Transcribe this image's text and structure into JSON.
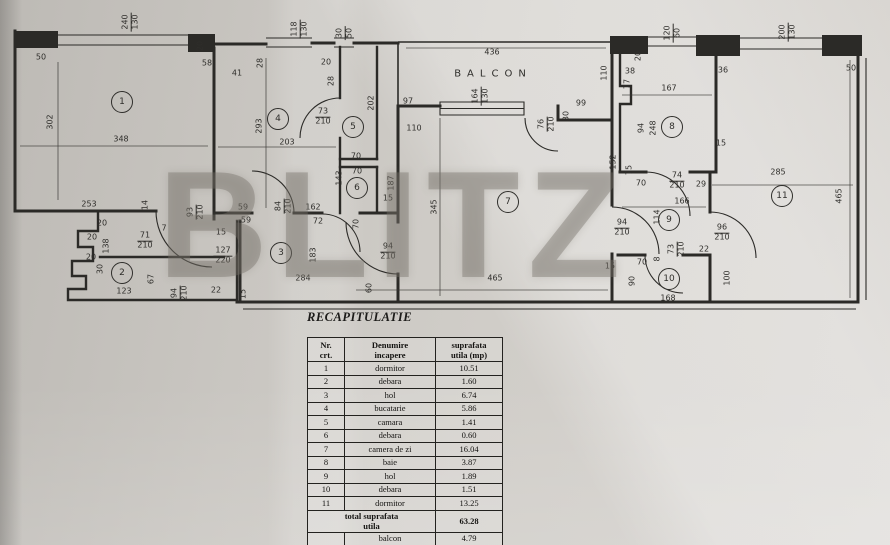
{
  "watermark": "BLITZ",
  "plan": {
    "balcony_label": "BALCON",
    "room_markers": [
      {
        "n": "1",
        "x": 122,
        "y": 102
      },
      {
        "n": "2",
        "x": 122,
        "y": 273
      },
      {
        "n": "3",
        "x": 281,
        "y": 253
      },
      {
        "n": "4",
        "x": 278,
        "y": 119
      },
      {
        "n": "5",
        "x": 353,
        "y": 127
      },
      {
        "n": "6",
        "x": 357,
        "y": 188
      },
      {
        "n": "7",
        "x": 508,
        "y": 202
      },
      {
        "n": "8",
        "x": 672,
        "y": 127
      },
      {
        "n": "9",
        "x": 669,
        "y": 220
      },
      {
        "n": "10",
        "x": 669,
        "y": 279
      },
      {
        "n": "11",
        "x": 782,
        "y": 196
      }
    ],
    "dim_labels": [
      {
        "t": "50",
        "x": 41,
        "y": 57
      },
      {
        "t": "20",
        "x": 200,
        "y": 46,
        "r": -90
      },
      {
        "t": "58",
        "x": 207,
        "y": 63
      },
      {
        "t": "302",
        "x": 50,
        "y": 122,
        "r": -90
      },
      {
        "t": "348",
        "x": 121,
        "y": 139
      },
      {
        "t": "253",
        "x": 89,
        "y": 204
      },
      {
        "t": "14",
        "x": 145,
        "y": 205,
        "r": -90
      },
      {
        "t": "7",
        "x": 164,
        "y": 228
      },
      {
        "t": "20",
        "x": 102,
        "y": 223
      },
      {
        "t": "20",
        "x": 92,
        "y": 237
      },
      {
        "t": "20",
        "x": 91,
        "y": 257
      },
      {
        "t": "138",
        "x": 106,
        "y": 246,
        "r": -90
      },
      {
        "t": "30",
        "x": 100,
        "y": 269,
        "r": -90
      },
      {
        "t": "123",
        "x": 124,
        "y": 291
      },
      {
        "t": "67",
        "x": 151,
        "y": 279,
        "r": -90
      },
      {
        "t": "59",
        "x": 243,
        "y": 207
      },
      {
        "t": "59",
        "x": 246,
        "y": 220
      },
      {
        "t": "15",
        "x": 221,
        "y": 232
      },
      {
        "t": "22",
        "x": 216,
        "y": 290
      },
      {
        "t": "15",
        "x": 243,
        "y": 294,
        "r": -90
      },
      {
        "t": "28",
        "x": 260,
        "y": 63,
        "r": -90
      },
      {
        "t": "41",
        "x": 237,
        "y": 73
      },
      {
        "t": "20",
        "x": 326,
        "y": 62
      },
      {
        "t": "28",
        "x": 331,
        "y": 81,
        "r": -90
      },
      {
        "t": "293",
        "x": 259,
        "y": 126,
        "r": -90
      },
      {
        "t": "203",
        "x": 287,
        "y": 142
      },
      {
        "t": "202",
        "x": 371,
        "y": 103,
        "r": -90
      },
      {
        "t": "97",
        "x": 408,
        "y": 101
      },
      {
        "t": "110",
        "x": 414,
        "y": 128
      },
      {
        "t": "70",
        "x": 356,
        "y": 156
      },
      {
        "t": "70",
        "x": 357,
        "y": 171
      },
      {
        "t": "143",
        "x": 339,
        "y": 178,
        "r": -90
      },
      {
        "t": "187",
        "x": 391,
        "y": 183,
        "r": -90
      },
      {
        "t": "15",
        "x": 388,
        "y": 198
      },
      {
        "t": "162",
        "x": 313,
        "y": 207
      },
      {
        "t": "72",
        "x": 318,
        "y": 221
      },
      {
        "t": "70",
        "x": 356,
        "y": 224,
        "r": -90
      },
      {
        "t": "183",
        "x": 313,
        "y": 255,
        "r": -90
      },
      {
        "t": "284",
        "x": 303,
        "y": 278
      },
      {
        "t": "60",
        "x": 369,
        "y": 288,
        "r": -90
      },
      {
        "t": "436",
        "x": 492,
        "y": 52
      },
      {
        "t": "345",
        "x": 434,
        "y": 207,
        "r": -90
      },
      {
        "t": "465",
        "x": 495,
        "y": 278
      },
      {
        "t": "99",
        "x": 581,
        "y": 103
      },
      {
        "t": "30",
        "x": 566,
        "y": 116,
        "r": -90
      },
      {
        "t": "20",
        "x": 638,
        "y": 56,
        "r": -90
      },
      {
        "t": "38",
        "x": 630,
        "y": 71
      },
      {
        "t": "77",
        "x": 627,
        "y": 84,
        "r": -90
      },
      {
        "t": "167",
        "x": 669,
        "y": 88
      },
      {
        "t": "36",
        "x": 723,
        "y": 70
      },
      {
        "t": "110",
        "x": 604,
        "y": 73,
        "r": -90
      },
      {
        "t": "50",
        "x": 851,
        "y": 68
      },
      {
        "t": "94",
        "x": 641,
        "y": 128,
        "r": -90
      },
      {
        "t": "248",
        "x": 653,
        "y": 128,
        "r": -90
      },
      {
        "t": "15",
        "x": 721,
        "y": 143
      },
      {
        "t": "285",
        "x": 778,
        "y": 172
      },
      {
        "t": "465",
        "x": 839,
        "y": 196,
        "r": -90
      },
      {
        "t": "152",
        "x": 613,
        "y": 162,
        "r": -90
      },
      {
        "t": "75",
        "x": 629,
        "y": 170,
        "r": -90
      },
      {
        "t": "70",
        "x": 641,
        "y": 183
      },
      {
        "t": "29",
        "x": 701,
        "y": 184
      },
      {
        "t": "166",
        "x": 682,
        "y": 201
      },
      {
        "t": "114",
        "x": 657,
        "y": 217,
        "r": -90
      },
      {
        "t": "22",
        "x": 704,
        "y": 249
      },
      {
        "t": "70",
        "x": 642,
        "y": 262
      },
      {
        "t": "8",
        "x": 657,
        "y": 259,
        "r": -90
      },
      {
        "t": "15",
        "x": 610,
        "y": 266
      },
      {
        "t": "90",
        "x": 632,
        "y": 281,
        "r": -90
      },
      {
        "t": "168",
        "x": 668,
        "y": 298
      },
      {
        "t": "100",
        "x": 727,
        "y": 278,
        "r": -90
      }
    ],
    "door_labels": [
      {
        "w": "240",
        "h": "130",
        "x": 131,
        "y": 22,
        "r": -90
      },
      {
        "w": "71",
        "h": "210",
        "x": 145,
        "y": 241
      },
      {
        "w": "93",
        "h": "210",
        "x": 196,
        "y": 212,
        "r": -90
      },
      {
        "w": "127",
        "h": "220",
        "x": 223,
        "y": 256
      },
      {
        "w": "94",
        "h": "210",
        "x": 180,
        "y": 293,
        "r": -90
      },
      {
        "w": "118",
        "h": "130",
        "x": 300,
        "y": 29,
        "r": -90
      },
      {
        "w": "30",
        "h": "50",
        "x": 345,
        "y": 33,
        "r": -90
      },
      {
        "w": "73",
        "h": "210",
        "x": 323,
        "y": 117
      },
      {
        "w": "84",
        "h": "210",
        "x": 284,
        "y": 206,
        "r": -90
      },
      {
        "w": "94",
        "h": "210",
        "x": 388,
        "y": 252
      },
      {
        "w": "164",
        "h": "130",
        "x": 481,
        "y": 96,
        "r": -90
      },
      {
        "w": "76",
        "h": "210",
        "x": 547,
        "y": 124,
        "r": -90
      },
      {
        "w": "120",
        "h": "60",
        "x": 673,
        "y": 33,
        "r": -90
      },
      {
        "w": "200",
        "h": "130",
        "x": 788,
        "y": 32,
        "r": -90
      },
      {
        "w": "74",
        "h": "210",
        "x": 677,
        "y": 181
      },
      {
        "w": "94",
        "h": "210",
        "x": 622,
        "y": 228
      },
      {
        "w": "96",
        "h": "210",
        "x": 722,
        "y": 233
      },
      {
        "w": "73",
        "h": "210",
        "x": 677,
        "y": 249,
        "r": -90
      }
    ]
  },
  "table": {
    "title": "RECAPITULATIE",
    "headers": {
      "nr": "Nr.\ncrt.",
      "name": "Denumire\nincapere",
      "area": "suprafata\nutila (mp)"
    },
    "rows": [
      {
        "nr": "1",
        "name": "dormitor",
        "area": "10.51"
      },
      {
        "nr": "2",
        "name": "debara",
        "area": "1.60"
      },
      {
        "nr": "3",
        "name": "hol",
        "area": "6.74"
      },
      {
        "nr": "4",
        "name": "bucatarie",
        "area": "5.86"
      },
      {
        "nr": "5",
        "name": "camara",
        "area": "1.41"
      },
      {
        "nr": "6",
        "name": "debara",
        "area": "0.60"
      },
      {
        "nr": "7",
        "name": "camera de zi",
        "area": "16.04"
      },
      {
        "nr": "8",
        "name": "baie",
        "area": "3.87"
      },
      {
        "nr": "9",
        "name": "hol",
        "area": "1.89"
      },
      {
        "nr": "10",
        "name": "debara",
        "area": "1.51"
      },
      {
        "nr": "11",
        "name": "dormitor",
        "area": "13.25"
      }
    ],
    "total_row": {
      "label": "total suprafata\nutila",
      "value": "63.28"
    },
    "balcon_row": {
      "label": "balcon",
      "value": "4.79"
    },
    "grand_total": {
      "label": "TOTAL",
      "value": "68.07"
    }
  }
}
